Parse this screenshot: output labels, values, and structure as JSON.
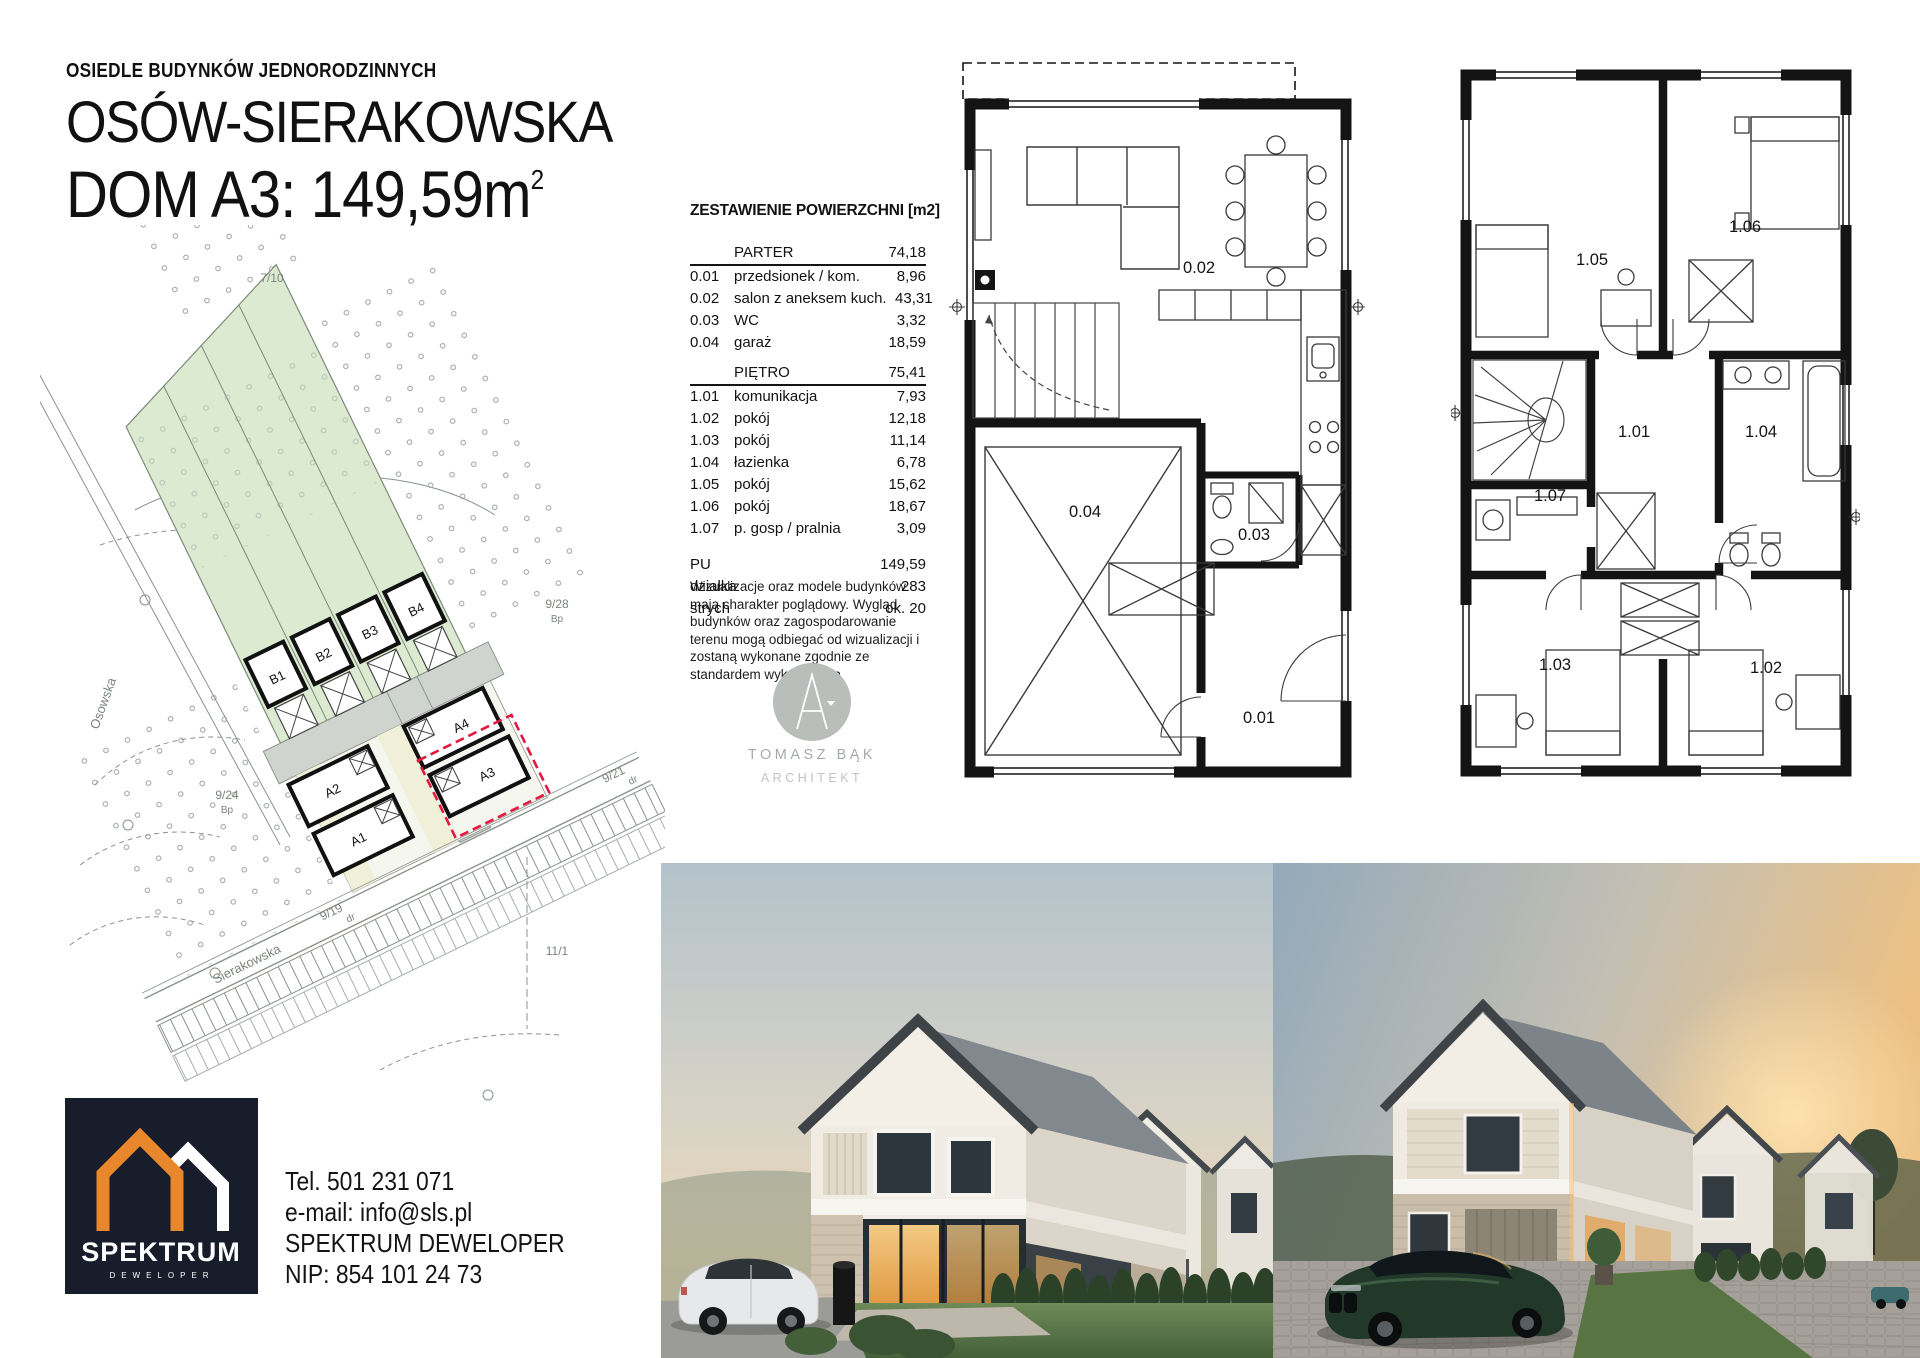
{
  "header": {
    "subtitle": "OSIEDLE BUDYNKÓW JEDNORODZINNYCH",
    "title": "OSÓW-SIERAKOWSKA",
    "unit": "DOM A3: 149,59m",
    "unit_sup": "2"
  },
  "area_table": {
    "title": "ZESTAWIENIE POWIERZCHNI [m2]",
    "sections": [
      {
        "name": "PARTER",
        "total": "74,18",
        "rows": [
          {
            "no": "0.01",
            "label": "przedsionek / kom.",
            "value": "8,96"
          },
          {
            "no": "0.02",
            "label": "salon z aneksem kuch.",
            "value": "43,31"
          },
          {
            "no": "0.03",
            "label": "WC",
            "value": "3,32"
          },
          {
            "no": "0.04",
            "label": "garaż",
            "value": "18,59"
          }
        ]
      },
      {
        "name": "PIĘTRO",
        "total": "75,41",
        "rows": [
          {
            "no": "1.01",
            "label": "komunikacja",
            "value": "7,93"
          },
          {
            "no": "1.02",
            "label": "pokój",
            "value": "12,18"
          },
          {
            "no": "1.03",
            "label": "pokój",
            "value": "11,14"
          },
          {
            "no": "1.04",
            "label": "łazienka",
            "value": "6,78"
          },
          {
            "no": "1.05",
            "label": "pokój",
            "value": "15,62"
          },
          {
            "no": "1.06",
            "label": "pokój",
            "value": "18,67"
          },
          {
            "no": "1.07",
            "label": "p. gosp / pralnia",
            "value": "3,09"
          }
        ]
      }
    ],
    "summary": [
      {
        "label": "PU",
        "value": "149,59"
      },
      {
        "label": "działka",
        "value": "283"
      },
      {
        "label": "strych",
        "value": "ok. 20"
      }
    ],
    "disclaimer": "Wizualizacje oraz modele budynków mają charakter poglądowy. Wygląd budynków oraz zagospodarowanie terenu mogą odbiegać od wizualizacji i zostaną wykonane zgodnie ze standardem wykończenia"
  },
  "architect": {
    "name": "TOMASZ BĄK",
    "role": "ARCHITEKT"
  },
  "site_plan": {
    "streets": {
      "osowska": "Osowska",
      "sierakowska": "Sierakowska"
    },
    "parcels": {
      "p710": "7/10",
      "p928": "9/28",
      "bp": "Bp",
      "p924": "9/24",
      "p921": "9/21",
      "dr": "dr",
      "p919": "9/19",
      "p111": "11/1"
    },
    "houses": {
      "b1": "B1",
      "b2": "B2",
      "b3": "B3",
      "b4": "B4",
      "a1": "A1",
      "a2": "A2",
      "a3": "A3",
      "a4": "A4"
    },
    "highlighted_house": "A3"
  },
  "floor_plans": {
    "ground": {
      "rooms": [
        "0.01",
        "0.02",
        "0.03",
        "0.04"
      ]
    },
    "upper": {
      "rooms": [
        "1.01",
        "1.02",
        "1.03",
        "1.04",
        "1.05",
        "1.06",
        "1.07"
      ]
    }
  },
  "contact": {
    "phone": "Tel. 501 231 071",
    "email": "e-mail: info@sls.pl",
    "company": "SPEKTRUM DEWELOPER",
    "nip": "NIP: 854 101 24 73",
    "logo_name": "SPEKTRUM",
    "logo_sub": "DEWELOPER"
  },
  "colors": {
    "highlight_red": "#e5173f",
    "brand_navy": "#181d2b",
    "brand_orange": "#e8872c",
    "plot_green": "#dcead2",
    "architect_gray": "#b9bebb"
  }
}
